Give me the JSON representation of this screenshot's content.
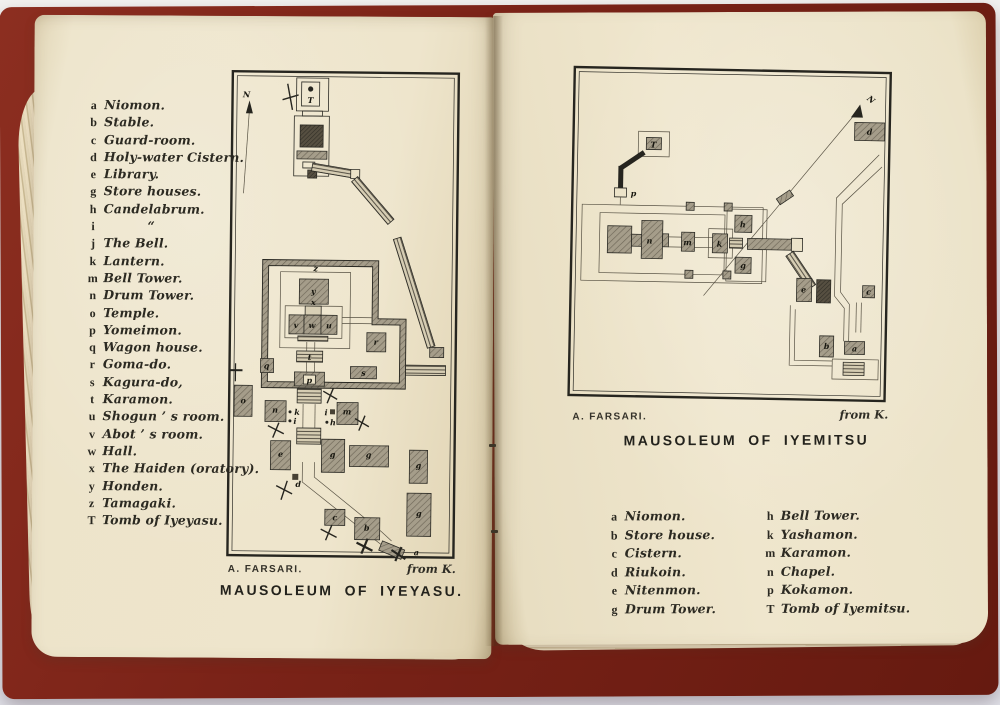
{
  "colors": {
    "cover_red": "#7b2318",
    "paper_cream": "#ece3c9",
    "map_ink": "#26251f",
    "hatch_gray": "#a59d8a",
    "background": "#e9eaee"
  },
  "legends": {
    "iyeyasu": [
      {
        "k": "a",
        "t": "Niomon."
      },
      {
        "k": "b",
        "t": "Stable."
      },
      {
        "k": "c",
        "t": "Guard-room."
      },
      {
        "k": "d",
        "t": "Holy-water Cistern."
      },
      {
        "k": "e",
        "t": "Library."
      },
      {
        "k": "g",
        "t": "Store houses."
      },
      {
        "k": "h",
        "t": "Candelabrum."
      },
      {
        "k": "i",
        "t": "“"
      },
      {
        "k": "j",
        "t": "The Bell."
      },
      {
        "k": "k",
        "t": "Lantern."
      },
      {
        "k": "m",
        "t": "Bell Tower."
      },
      {
        "k": "n",
        "t": "Drum Tower."
      },
      {
        "k": "o",
        "t": "Temple."
      },
      {
        "k": "p",
        "t": "Yomeimon."
      },
      {
        "k": "q",
        "t": "Wagon house."
      },
      {
        "k": "r",
        "t": "Goma-do."
      },
      {
        "k": "s",
        "t": "Kagura-do,"
      },
      {
        "k": "t",
        "t": "Karamon."
      },
      {
        "k": "u",
        "t": "Shogun ’ s room."
      },
      {
        "k": "v",
        "t": "Abot ’ s room."
      },
      {
        "k": "w",
        "t": "Hall."
      },
      {
        "k": "x",
        "t": "The Haiden (oratory)."
      },
      {
        "k": "y",
        "t": "Honden."
      },
      {
        "k": "z",
        "t": "Tamagaki."
      },
      {
        "k": "T",
        "t": "Tomb of Iyeyasu."
      }
    ],
    "iyemitsu_col1": [
      {
        "k": "a",
        "t": "Niomon."
      },
      {
        "k": "b",
        "t": "Store house."
      },
      {
        "k": "c",
        "t": "Cistern."
      },
      {
        "k": "d",
        "t": "Riukoin."
      },
      {
        "k": "e",
        "t": "Nitenmon."
      },
      {
        "k": "g",
        "t": "Drum Tower."
      }
    ],
    "iyemitsu_col2": [
      {
        "k": "h",
        "t": "Bell Tower."
      },
      {
        "k": "k",
        "t": "Yashamon."
      },
      {
        "k": "m",
        "t": "Karamon."
      },
      {
        "k": "n",
        "t": "Chapel."
      },
      {
        "k": "p",
        "t": "Kokamon."
      },
      {
        "k": "T",
        "t": "Tomb of Iyemitsu."
      }
    ]
  },
  "maps": {
    "iyeyasu": {
      "title": "MAUSOLEUM OF IYEYASU.",
      "credit": "A. FARSARI.",
      "source": "from K.",
      "north": "N",
      "marks": {
        "a": "a",
        "b": "b",
        "c": "c",
        "d": "d",
        "e": "e",
        "g": "g",
        "h": "h",
        "i": "i",
        "k": "k",
        "m": "m",
        "n": "n",
        "o": "o",
        "p": "p",
        "q": "q",
        "r": "r",
        "s": "s",
        "t": "t",
        "u": "u",
        "v": "v",
        "w": "w",
        "x": "x",
        "y": "y",
        "z": "z",
        "T": "T"
      }
    },
    "iyemitsu": {
      "title": "MAUSOLEUM OF IYEMITSU",
      "credit": "A. FARSARI.",
      "source": "from K.",
      "north": "N",
      "marks": {
        "a": "a",
        "b": "b",
        "c": "c",
        "d": "d",
        "e": "e",
        "g": "g",
        "h": "h",
        "k": "k",
        "m": "m",
        "n": "n",
        "p": "p",
        "T": "T"
      }
    }
  }
}
